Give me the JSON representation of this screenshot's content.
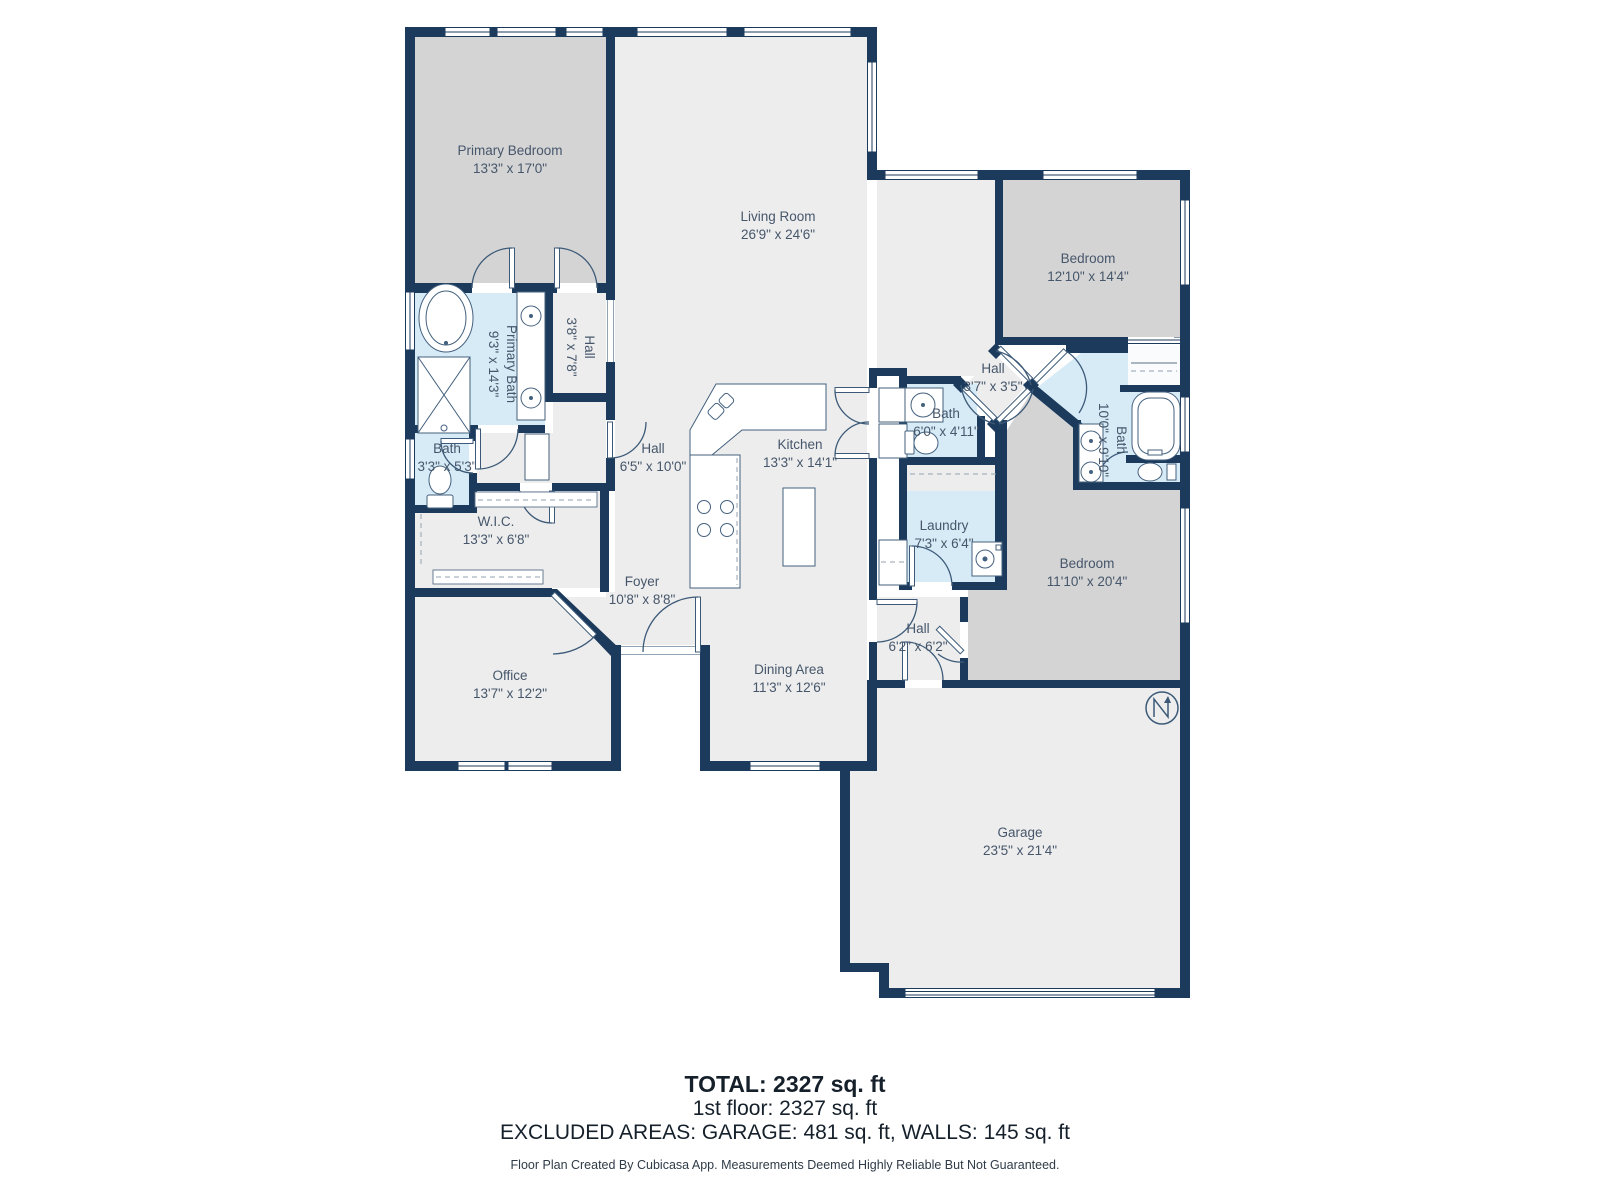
{
  "plan": {
    "type": "floor-plan",
    "source_note": "Floor Plan Created By Cubicasa App. Measurements Deemed Highly Reliable But Not Guaranteed."
  },
  "rooms": [
    {
      "id": "primary-bedroom",
      "name": "Primary Bedroom",
      "dims": "13'3\" x 17'0\""
    },
    {
      "id": "living-room",
      "name": "Living Room",
      "dims": "26'9\" x 24'6\""
    },
    {
      "id": "bedroom-top",
      "name": "Bedroom",
      "dims": "12'10\" x 14'4\""
    },
    {
      "id": "primary-bath",
      "name": "Primary Bath",
      "dims": "9'3\" x 14'3\""
    },
    {
      "id": "hall-small",
      "name": "Hall",
      "dims": "3'8\" x 7'8\""
    },
    {
      "id": "bath-small",
      "name": "Bath",
      "dims": "3'3\" x 5'3\""
    },
    {
      "id": "wic",
      "name": "W.I.C.",
      "dims": "13'3\" x 6'8\""
    },
    {
      "id": "hall-main",
      "name": "Hall",
      "dims": "6'5\" x 10'0\""
    },
    {
      "id": "kitchen",
      "name": "Kitchen",
      "dims": "13'3\" x 14'1\""
    },
    {
      "id": "bath-mid",
      "name": "Bath",
      "dims": "6'0\" x 4'11\""
    },
    {
      "id": "hall-diamond",
      "name": "Hall",
      "dims": "3'7\" x 3'5\""
    },
    {
      "id": "bath-right",
      "name": "Bath",
      "dims": "10'0\" x 9'10\""
    },
    {
      "id": "laundry",
      "name": "Laundry",
      "dims": "7'3\" x 6'4\""
    },
    {
      "id": "bedroom-right",
      "name": "Bedroom",
      "dims": "11'10\" x 20'4\""
    },
    {
      "id": "foyer",
      "name": "Foyer",
      "dims": "10'8\" x 8'8\""
    },
    {
      "id": "office",
      "name": "Office",
      "dims": "13'7\" x 12'2\""
    },
    {
      "id": "dining",
      "name": "Dining Area",
      "dims": "11'3\" x 12'6\""
    },
    {
      "id": "hall-garage",
      "name": "Hall",
      "dims": "6'2\" x 6'2\""
    },
    {
      "id": "garage",
      "name": "Garage",
      "dims": "23'5\" x 21'4\""
    }
  ],
  "footer": {
    "total": "TOTAL: 2327 sq. ft",
    "floor1": "1st floor: 2327 sq. ft",
    "excluded": "EXCLUDED AREAS: GARAGE: 481 sq. ft, WALLS: 145 sq. ft",
    "credit": "Floor Plan Created By Cubicasa App. Measurements Deemed Highly Reliable But Not Guaranteed."
  },
  "colors": {
    "wall": "#1c3a5c",
    "bedroom_fill": "#d4d4d4",
    "bath_fill": "#d7ebf7",
    "floor_fill": "#ededed",
    "label_text": "#46566b"
  },
  "icons": {
    "compass": "north-arrow"
  }
}
